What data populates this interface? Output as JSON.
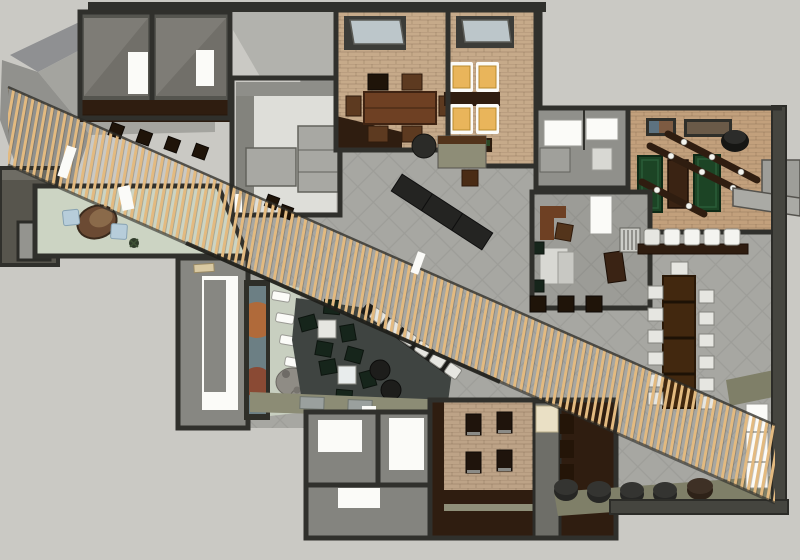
{
  "scene": {
    "type": "3d-floor-plan-render",
    "view": "top-down-axonometric",
    "setting": "restaurant-bar-interior",
    "width_px": 800,
    "height_px": 560
  },
  "colors": {
    "background": "#cac9c4",
    "wall": "#30302c",
    "wallMid": "#55554f",
    "wallLight": "#83837d",
    "roofA": "#8f9092",
    "roofB": "#a4a49f",
    "roofC": "#91918d",
    "roofFlat": "#b2b2ad",
    "tile": "#a7a7a2",
    "roomGray": "#716f69",
    "roomGrayLight": "#7e7c76",
    "floorWhite": "#deded9",
    "white": "#fbfbf8",
    "cream": "#eae0c5",
    "brick": "#c6aa8a",
    "brickGame": "#c2a07c",
    "brickPatio": "#bda387",
    "paleGreen": "#ccd4c3",
    "paleGreenStrip": "#c8cfc0",
    "lightBlue": "#b7cdda",
    "amber": "#e9b55b",
    "felt": "#1c4425",
    "woodDark": "#2f1d10",
    "wood": "#53341b",
    "woodMid": "#6e4023",
    "woodTable": "#42280f",
    "slat": "#e3ba80",
    "lounge": "#3f4441",
    "chairGreen": "#16251b",
    "chairWhite": "#e6e6e1",
    "stoolDark": "#1f1409",
    "stoolCyl": "#262624",
    "khaki": "#7f7f68",
    "khakiLight": "#8c8c75",
    "stone": "#8f8c85",
    "black": "#161614",
    "muralBg": "#6c7f84",
    "muralOrange": "#b06a3a",
    "muralRust": "#8a4a34",
    "glass": "#bcc6ca",
    "duct": "#9e9e99",
    "counterDark": "#242422",
    "storageGray": "#90908b",
    "officeFloor": "#9c9c97",
    "restroomFloor": "#84847f",
    "vestGray": "#878782"
  },
  "regions": {
    "slat_screen": "diagonal timber slat screen crossing plan from upper-left to lower-right",
    "private_dining": {
      "chairs": 6,
      "tables": 1
    },
    "booth_room": {
      "lit_seats": 4
    },
    "game_room": {
      "green_tables": 2,
      "wood_tables": 1,
      "light_bars": 3,
      "wall_pictures": 2
    },
    "bar_counter": {
      "white_stools": 5
    },
    "communal_table": {
      "side_chairs": 12,
      "head_chairs": 1
    },
    "lounge": {
      "white_tables": 2,
      "green_chairs": 8,
      "round_stools": 2,
      "booth_seats": 6
    },
    "reception": {
      "blue_seats": 2,
      "desk": 1
    },
    "patio_nook": {
      "dark_tables": 4
    },
    "floor_stools_row": 5,
    "restrooms": {
      "fixture_zones": 3
    }
  }
}
